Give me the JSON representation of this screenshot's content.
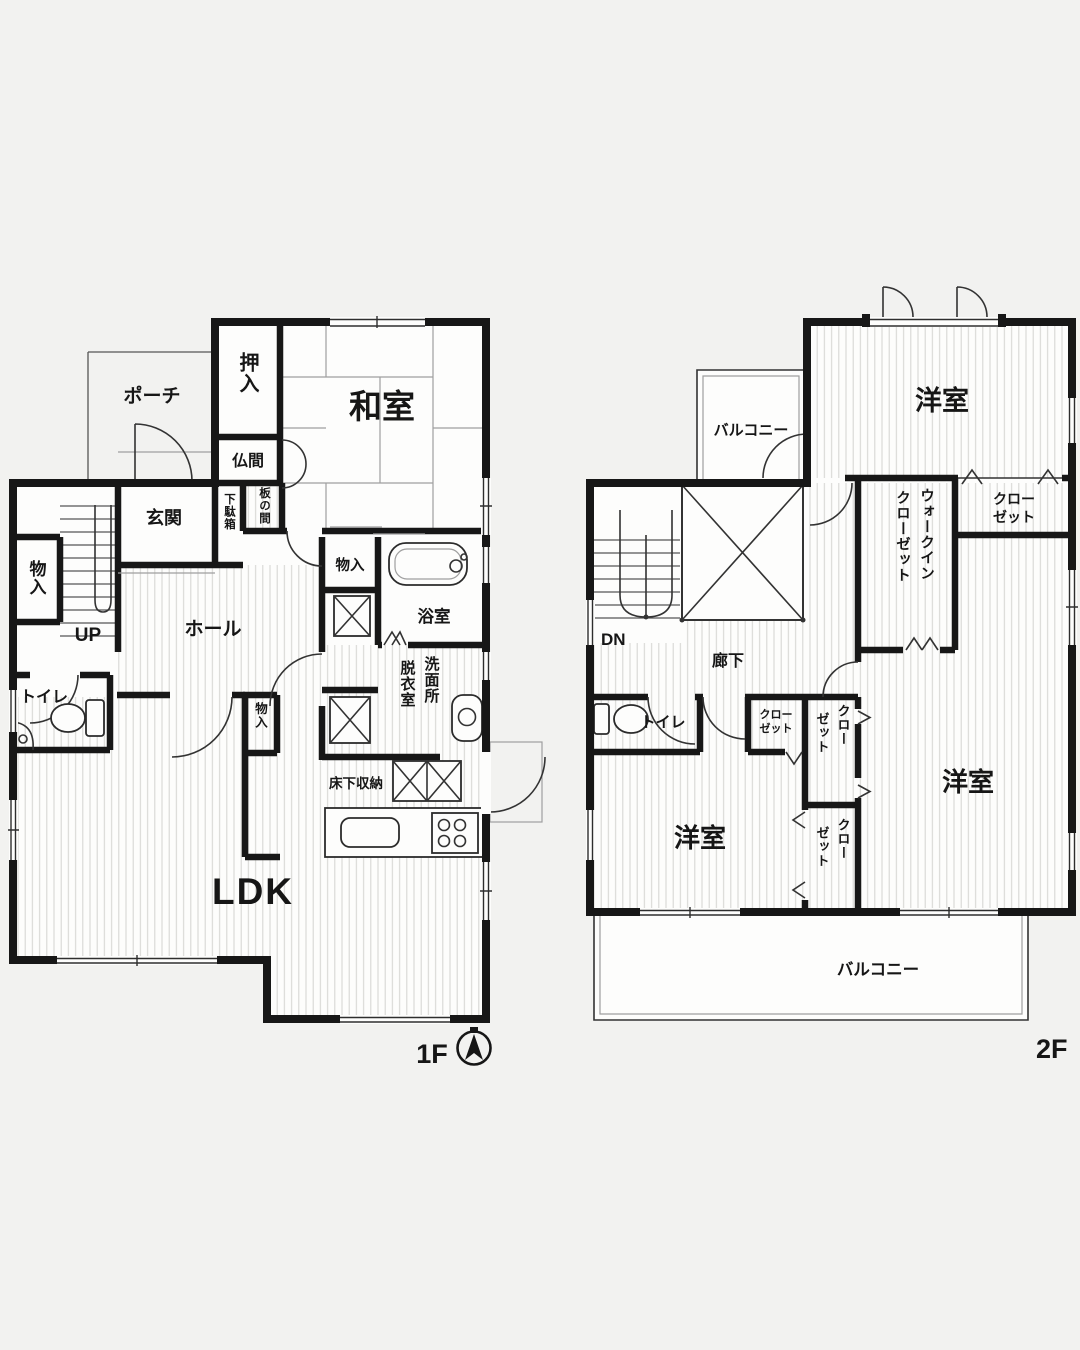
{
  "colors": {
    "background": "#f2f2f0",
    "wall": "#171717",
    "floor": "#fdfdfc",
    "hatch": "#d7d7d4",
    "accent": "#161616"
  },
  "floor1": {
    "label": "1F",
    "rooms": {
      "porch": "ポーチ",
      "oshiire": "押入",
      "washitsu": "和室",
      "butsuma": "仏間",
      "getabako": "下駄箱",
      "itanoma": "板の間",
      "genkan": "玄関",
      "storage_left": "物入",
      "stairs_up": "UP",
      "toilet": "トイレ",
      "hall": "ホール",
      "storage_mid": "物入",
      "bathroom": "浴室",
      "washroom_col_right": "洗面所",
      "washroom_col_left": "脱衣室",
      "storage_hall": "物入",
      "underfloor_storage": "床下収納",
      "ldk": "LDK"
    }
  },
  "floor2": {
    "label": "2F",
    "rooms": {
      "balcony_upper": "バルコニー",
      "bedroom_top": "洋室",
      "closet_top_line1": "クロー",
      "closet_top_line2": "ゼット",
      "wic_col_right": "ウォークイン",
      "wic_col_left": "クローゼット",
      "stairs_down": "DN",
      "corridor": "廊下",
      "toilet": "トイレ",
      "closet_hall_line1": "クロー",
      "closet_hall_line2": "ゼット",
      "closet_a_col_right": "クロー",
      "closet_a_col_left": "ゼット",
      "closet_b_col_right": "クロー",
      "closet_b_col_left": "ゼット",
      "bedroom_left": "洋室",
      "bedroom_right": "洋室",
      "balcony_lower": "バルコニー"
    }
  }
}
